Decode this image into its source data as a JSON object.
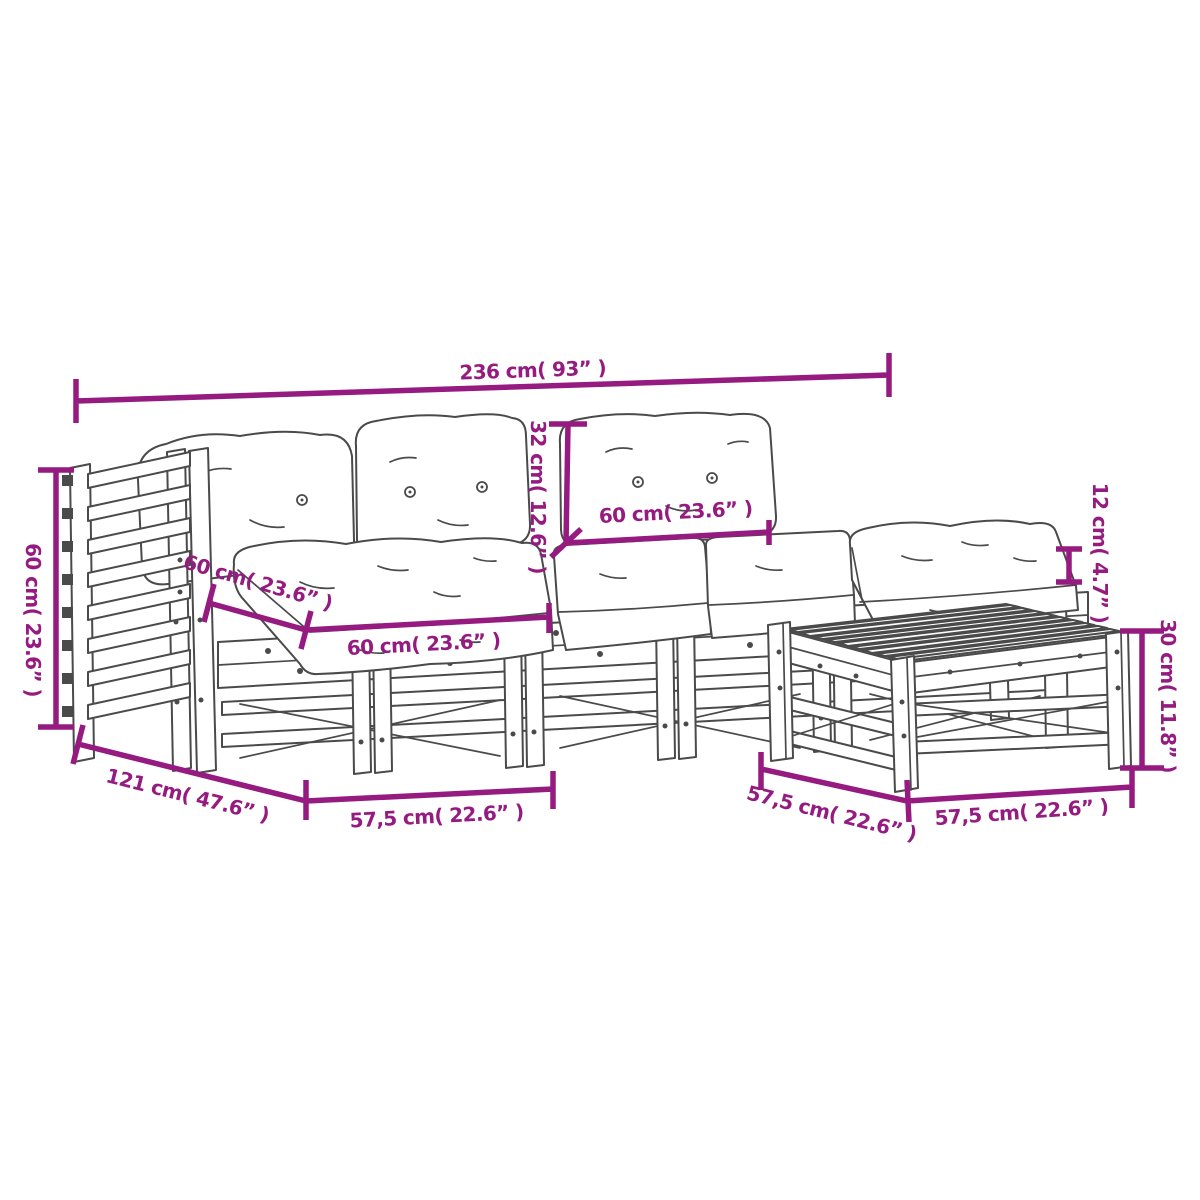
{
  "colors": {
    "dimension": "#951b81",
    "line": "#4a4a4a",
    "background": "#ffffff"
  },
  "dims": {
    "overall_width": {
      "label": "236 cm( 93” )",
      "cm": 236,
      "inches": 93
    },
    "armrest_height": {
      "label": "60 cm( 23.6” )",
      "cm": 60,
      "inches": 23.6
    },
    "back_cushion_height": {
      "label": "32 cm( 12.6” )",
      "cm": 32,
      "inches": 12.6
    },
    "back_cushion_width": {
      "label": "60 cm( 23.6” )",
      "cm": 60,
      "inches": 23.6
    },
    "seat_cushion_depth": {
      "label": "60 cm( 23.6” )",
      "cm": 60,
      "inches": 23.6
    },
    "seat_cushion_width": {
      "label": "60 cm( 23.6” )",
      "cm": 60,
      "inches": 23.6
    },
    "cushion_thickness": {
      "label": "12 cm( 4.7” )",
      "cm": 12,
      "inches": 4.7
    },
    "stool_height": {
      "label": "30 cm( 11.8” )",
      "cm": 30,
      "inches": 11.8
    },
    "seat_depth": {
      "label": "121 cm( 47.6” )",
      "cm": 121,
      "inches": 47.6
    },
    "module_width_left": {
      "label": "57,5 cm( 22.6” )",
      "cm": 57.5,
      "inches": 22.6
    },
    "module_width_mid": {
      "label": "57,5 cm( 22.6” )",
      "cm": 57.5,
      "inches": 22.6
    },
    "module_width_right": {
      "label": "57,5 cm( 22.6” )",
      "cm": 57.5,
      "inches": 22.6
    }
  }
}
